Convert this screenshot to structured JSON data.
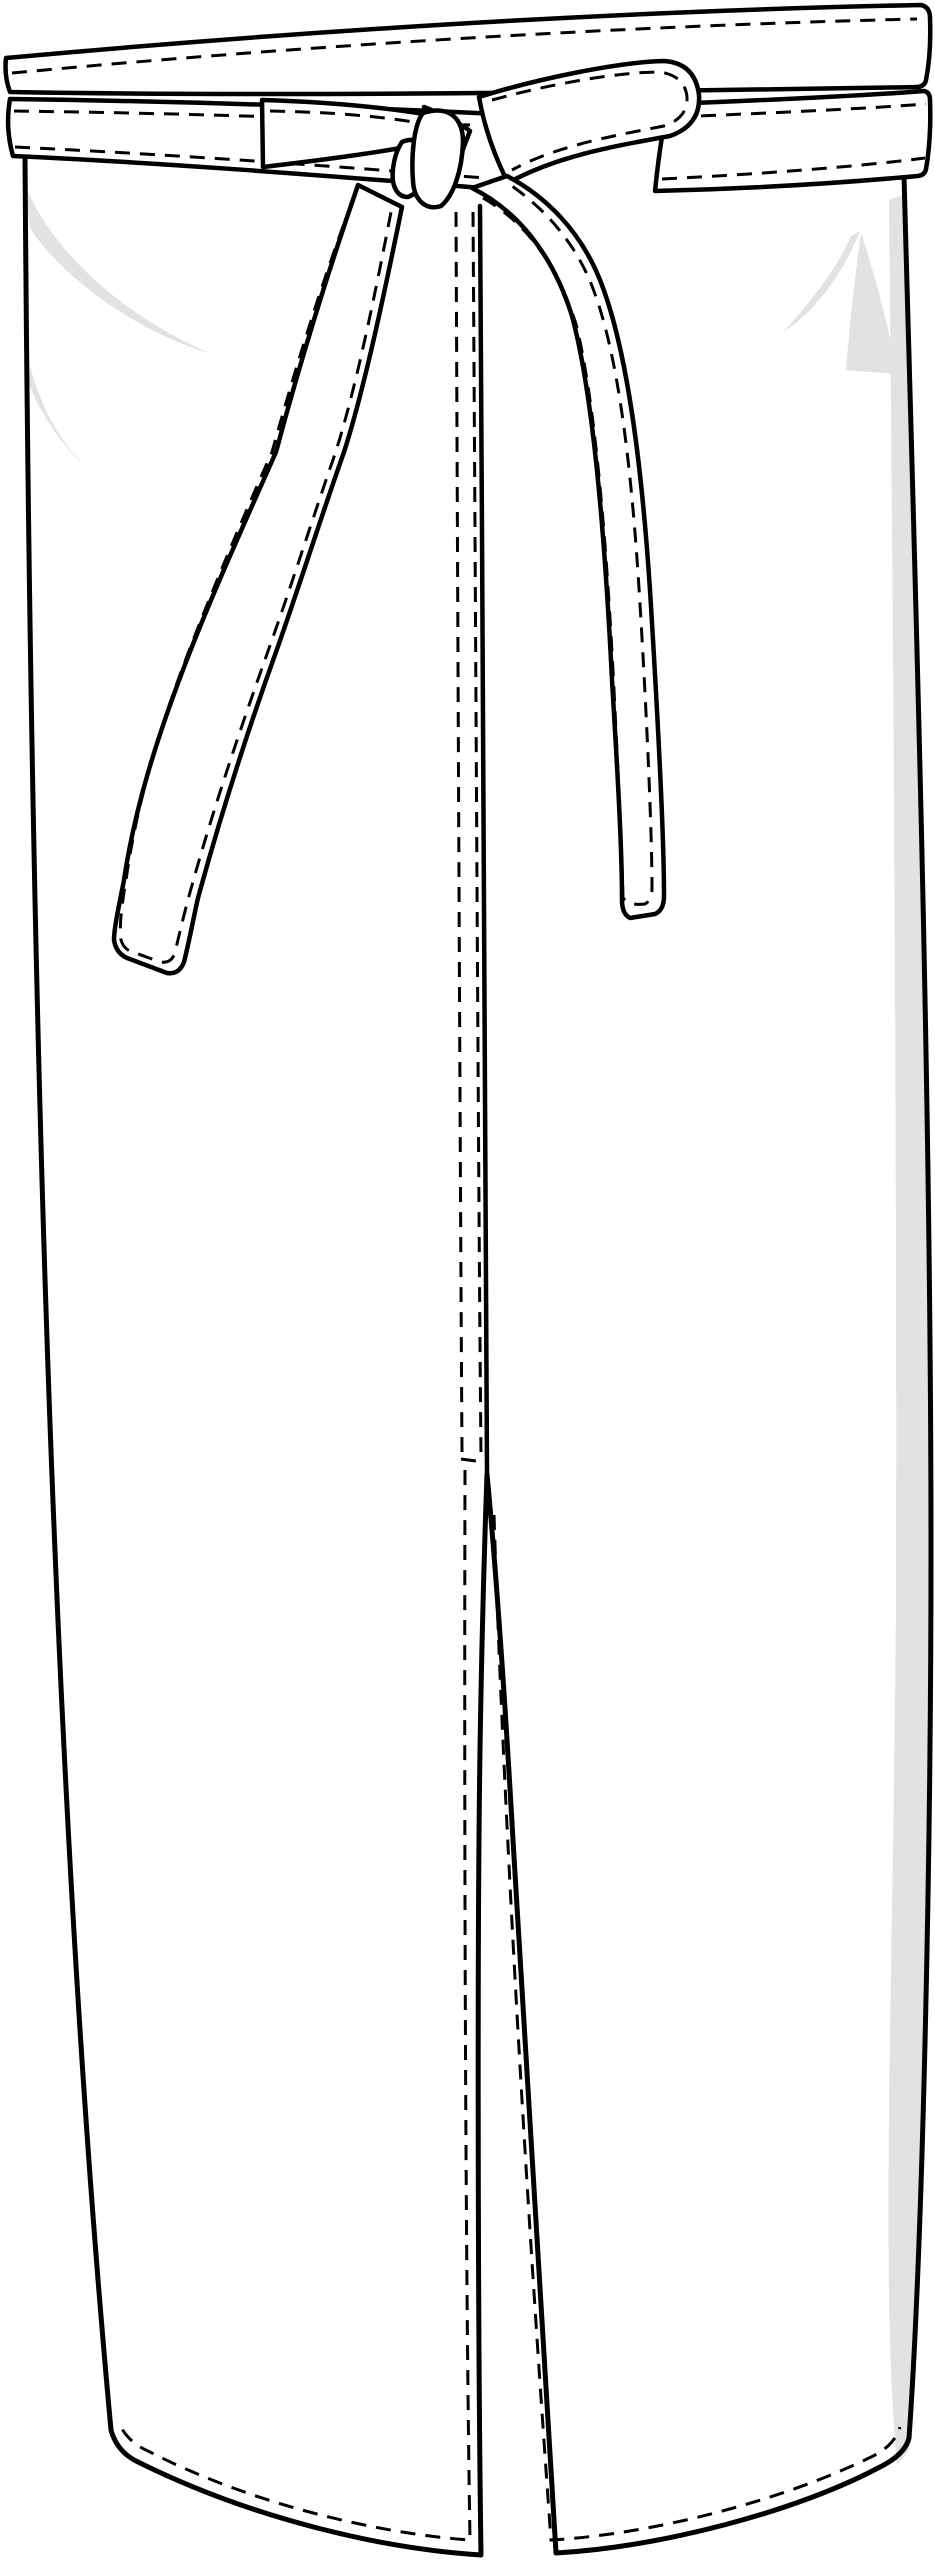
{
  "canvas": {
    "width": 935,
    "height": 2560
  },
  "colors": {
    "ink": "#000000",
    "paper": "#ffffff",
    "shade": "#e2e2e2",
    "background": "#ffffff"
  },
  "stitch": {
    "dash_length": 15,
    "dash_gap": 10,
    "stroke_width": 3
  },
  "illustration": {
    "kind": "technical flat sketch, black line art on white",
    "garment": "Long bistro wrap apron with waist-tie bow, front view",
    "parts": [
      {
        "name": "top-band",
        "desc": "folded top edge band with single row of topstitching"
      },
      {
        "name": "waist-tie-band",
        "desc": "tie wrapped across waist, topstitched along both edges"
      },
      {
        "name": "bow-knot",
        "desc": "knot left of center with flat left fold and right-pointing loop"
      },
      {
        "name": "left-tie-end",
        "desc": "tie falling diagonally to lower left with rounded square stitched tip"
      },
      {
        "name": "right-tie-end",
        "desc": "tie falling to lower right with rounded square stitched tip"
      },
      {
        "name": "center-front-placket",
        "desc": "overlap edge with two dashed topstitch rows ending in a bar tack above the vent"
      },
      {
        "name": "center-vent",
        "desc": "open slit from mid-thigh to hem, edges topstitched"
      },
      {
        "name": "hem",
        "desc": "curved hem with parallel topstitching"
      },
      {
        "name": "shading",
        "desc": "soft gray highlight strokes at upper corners and along right edge"
      }
    ]
  }
}
